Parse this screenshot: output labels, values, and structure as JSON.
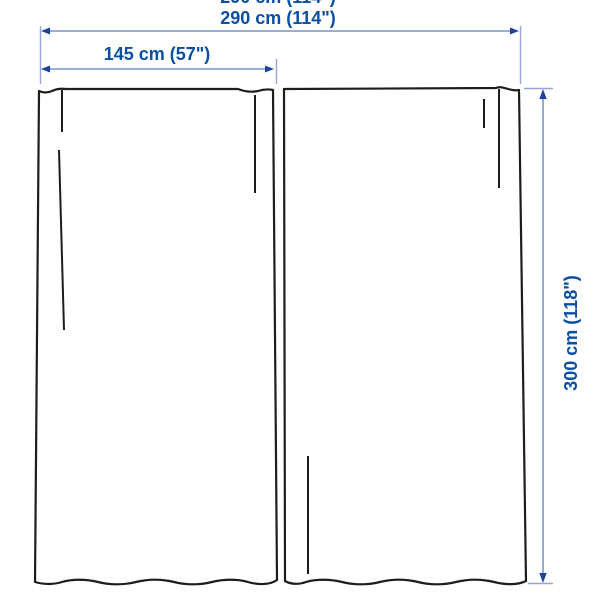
{
  "diagram": {
    "type": "product-dimension-diagram",
    "subject": "pair of curtain panels",
    "labels": {
      "total_width": "290 cm (114\")",
      "panel_width": "145 cm (57\")",
      "panel_height": "300 cm (118\")",
      "cropped_top_label": "290 cm (114\")"
    },
    "measurements": {
      "total_width_cm": 290,
      "total_width_in": 114,
      "panel_width_cm": 145,
      "panel_width_in": 57,
      "panel_height_cm": 300,
      "panel_height_in": 118,
      "panel_count": 2
    },
    "colors": {
      "background": "#ffffff",
      "curtain_outline": "#1d1d1d",
      "dimension_line": "#7d93c6",
      "extension_line": "#93a6d4",
      "arrowhead": "#1d429e",
      "label_text": "#0b4fa4"
    }
  }
}
